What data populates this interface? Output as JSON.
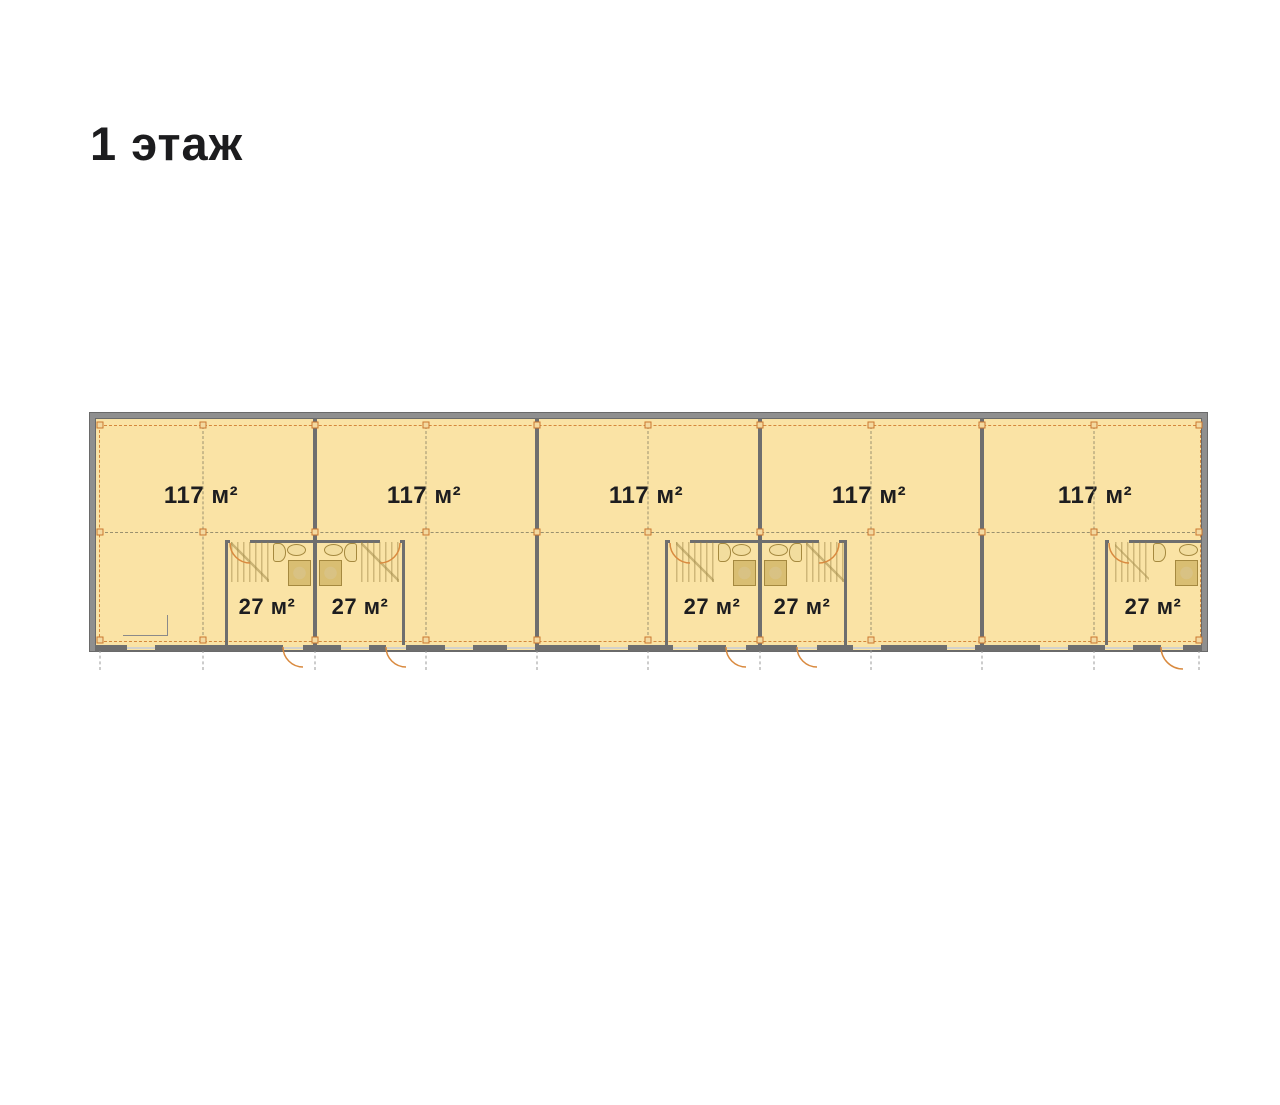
{
  "title": "1 этаж",
  "plan": {
    "units": [
      {
        "area_label": "117 м²"
      },
      {
        "area_label": "117 м²"
      },
      {
        "area_label": "117 м²"
      },
      {
        "area_label": "117 м²"
      },
      {
        "area_label": "117 м²"
      }
    ],
    "rooms": [
      {
        "area_label": "27 м²"
      },
      {
        "area_label": "27 м²"
      },
      {
        "area_label": "27 м²"
      },
      {
        "area_label": "27 м²"
      },
      {
        "area_label": "27 м²"
      }
    ]
  },
  "colors": {
    "floor": "#FAE3A5",
    "wall": "#6E6E6E",
    "accent_orange": "#D4873C",
    "text": "#1C1C1E",
    "background": "#FFFFFF"
  }
}
